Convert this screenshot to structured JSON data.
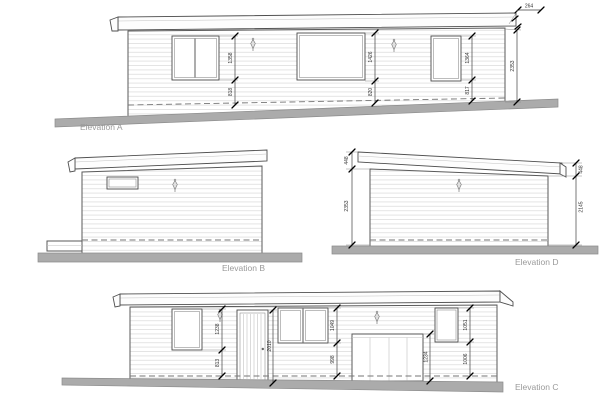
{
  "drawing": {
    "type": "architectural-elevations",
    "labels": {
      "elevation_a": "Elevation A",
      "elevation_b": "Elevation B",
      "elevation_c": "Elevation C",
      "elevation_d": "Elevation D"
    },
    "colors": {
      "outline": "#5a5a5a",
      "siding_line": "#dedede",
      "ground": "#ababab",
      "label_text": "#9a9a9a",
      "dim_text": "#333333"
    },
    "icons": {
      "wall_light": "wall-lamp-icon"
    },
    "dimensions": {
      "a": {
        "window1_height": "1358",
        "window1_sill": "818",
        "window2_height": "1426",
        "window2_sill": "820",
        "window3_height": "1364",
        "window3_sill": "817",
        "wall_height": "2353",
        "roof_overhang": "264"
      },
      "d": {
        "fascia_left": "448",
        "wall_left": "2353",
        "fascia_right": "448",
        "wall_right": "2145"
      },
      "c": {
        "window1_height": "1238",
        "window1_sill": "813",
        "door_height": "2010",
        "window2_height": "1049",
        "window2_sill": "998",
        "tank_height": "1234",
        "window3_height": "1051",
        "window3_sill": "1006"
      }
    }
  }
}
